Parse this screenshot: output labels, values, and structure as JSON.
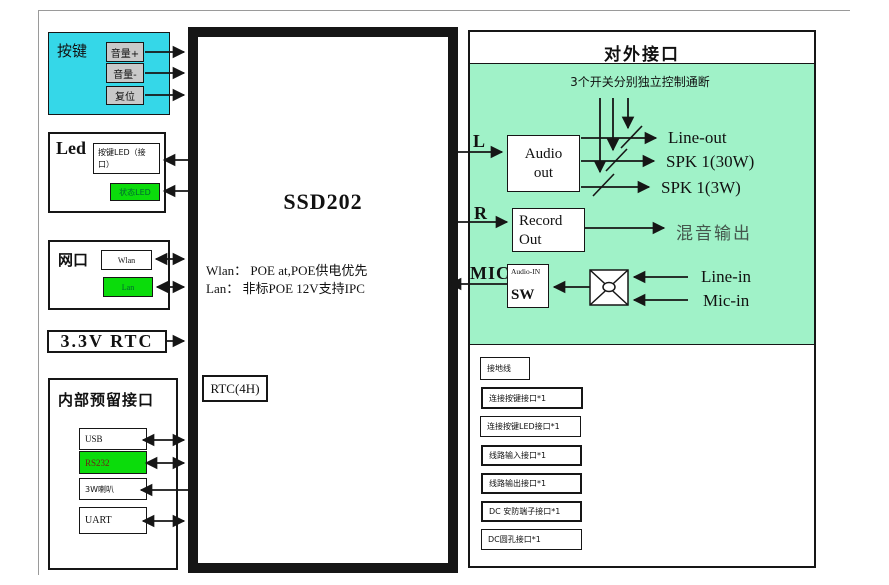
{
  "colors": {
    "cyan_panel": "#35d7e8",
    "bright_green": "#0bdc0b",
    "mint_green": "#a0f2c8",
    "gray_button": "#c9c9c9",
    "mix_out_text": "#44564c",
    "rs232_text": "#6e2318",
    "line_black": "#161616"
  },
  "left": {
    "keypad": {
      "title": "按键",
      "buttons": [
        "音量+",
        "音量-",
        "复位"
      ]
    },
    "led": {
      "title": "Led",
      "button_led": "按键LED（接口）",
      "status_led": "状态LED"
    },
    "network": {
      "title": "网口",
      "wlan": "Wlan",
      "lan": "Lan"
    },
    "rtc": {
      "label": "3.3V RTC"
    },
    "internal": {
      "title": "内部预留接口",
      "items": [
        "USB",
        "RS232",
        "3W喇叭",
        "UART"
      ]
    }
  },
  "center": {
    "title": "SSD202",
    "note_line1": "Wlan： POE at,POE供电优先",
    "note_line2": "Lan：  非标POE 12V支持IPC",
    "rtc_box": "RTC(4H)"
  },
  "right": {
    "title": "对外接口",
    "switch_note": "3个开关分别独立控制通断",
    "l_label": "L",
    "r_label": "R",
    "mic_label": "MIC",
    "audio_out": "Audio out",
    "record_out": "Record Out",
    "audio_in_top": "Audio-IN",
    "audio_in_bottom": "SW",
    "outputs": [
      "Line-out",
      "SPK 1(30W)",
      "SPK 1(3W)"
    ],
    "mix_out": "混音输出",
    "line_in": "Line-in",
    "mic_in": "Mic-in",
    "connectors": [
      "接地线",
      "连接按键接口*1",
      "连接按键LED接口*1",
      "线路输入接口*1",
      "线路输出接口*1",
      "DC 安防端子接口*1",
      "DC圆孔接口*1"
    ]
  }
}
